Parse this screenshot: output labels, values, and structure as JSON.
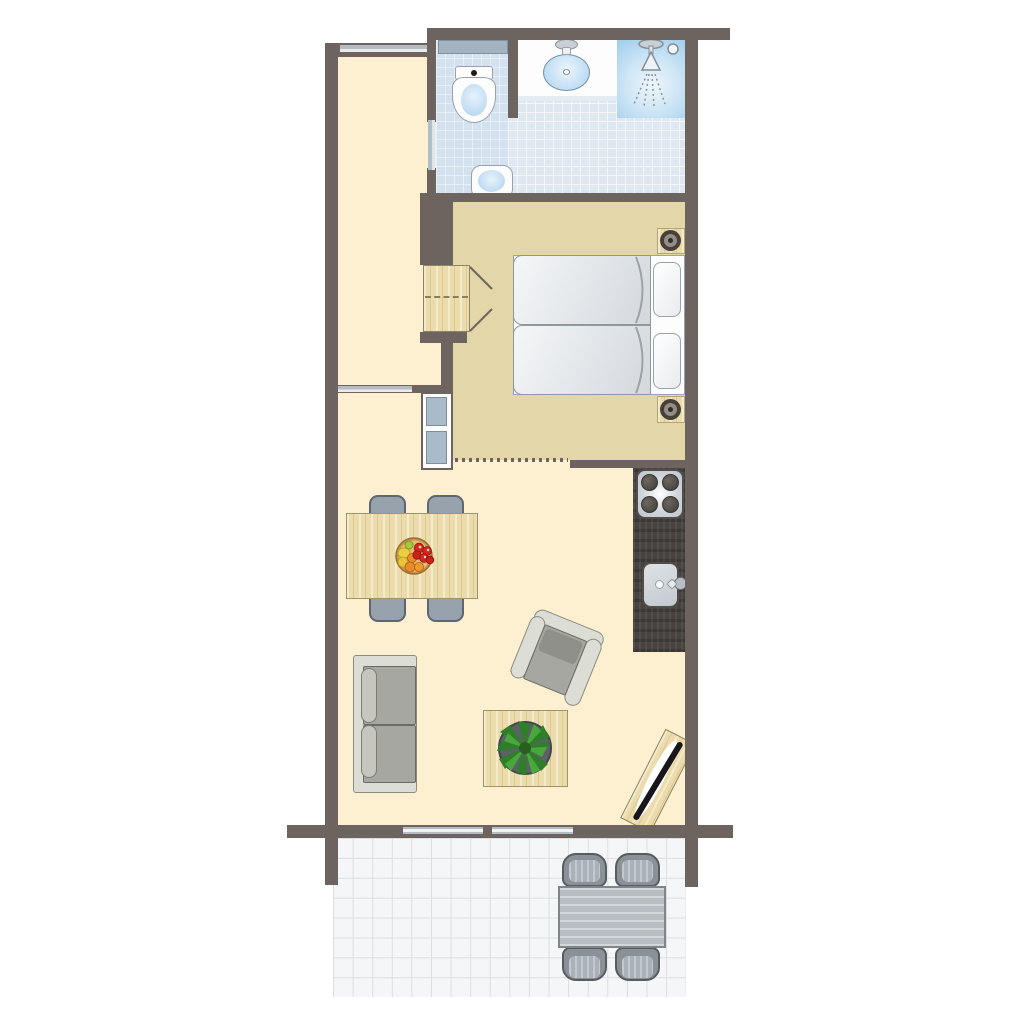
{
  "diagram": {
    "type": "floor-plan",
    "description": "Top-down apartment floor plan: hallway, bathroom with separate WC corner, bedroom with twin beds, open kitchen, living-dining room and tiled terrace with outdoor dining set",
    "colors": {
      "wall": "#6d6460",
      "hallway_floor": "#fcf0d0",
      "living_floor": "#fcf0d0",
      "bedroom_floor": "#e3d6a9",
      "bathroom_tile": "#dfe8f1",
      "shower_blue": "#a6d2ee",
      "terrace_tile": "#f5f6f8",
      "light_wood": "#ecdcab",
      "kitchen_counter": "#474340",
      "door_panel": "#aebfcc",
      "window_bar": "#b6bdc2",
      "fixture_blue": "#b5d8f1",
      "sofa_gray": "#a7a7a1",
      "outdoor_gray": "#b7bec4",
      "plant_green": "#3f9e35",
      "fruit_red": "#d6281e"
    },
    "rooms": [
      {
        "id": "hallway",
        "items": [
          "entrance-window",
          "bathroom-door",
          "hall-opening"
        ]
      },
      {
        "id": "bathroom",
        "items": [
          "toilet",
          "radiator-shelf",
          "vanity-washbasin",
          "small-washbasin",
          "shower",
          "shower-drain"
        ]
      },
      {
        "id": "bedroom",
        "items": [
          "twin-bed",
          "twin-bed",
          "pillow",
          "pillow",
          "nightstand-with-lamp",
          "nightstand-with-lamp",
          "wardrobe-with-open-doors",
          "sliding-door",
          "dotted-open-passage"
        ]
      },
      {
        "id": "kitchen",
        "items": [
          "hob-with-4-burners",
          "kitchen-sink-with-tap",
          "dark-wood-counter"
        ]
      },
      {
        "id": "living-room",
        "items": [
          "dining-table",
          "dining-chair",
          "dining-chair",
          "dining-chair",
          "dining-chair",
          "fruit-bowl",
          "two-seat-sofa",
          "armchair",
          "coffee-table",
          "potted-plant",
          "tv-unit"
        ]
      },
      {
        "id": "terrace",
        "items": [
          "sliding-glass-door",
          "sliding-glass-door",
          "outdoor-table",
          "outdoor-chair",
          "outdoor-chair",
          "outdoor-chair",
          "outdoor-chair"
        ]
      }
    ],
    "counts": {
      "beds": 2,
      "dining_chairs": 4,
      "outdoor_chairs": 4,
      "nightstands": 2,
      "washbasins": 2,
      "hob_burners": 4
    }
  }
}
